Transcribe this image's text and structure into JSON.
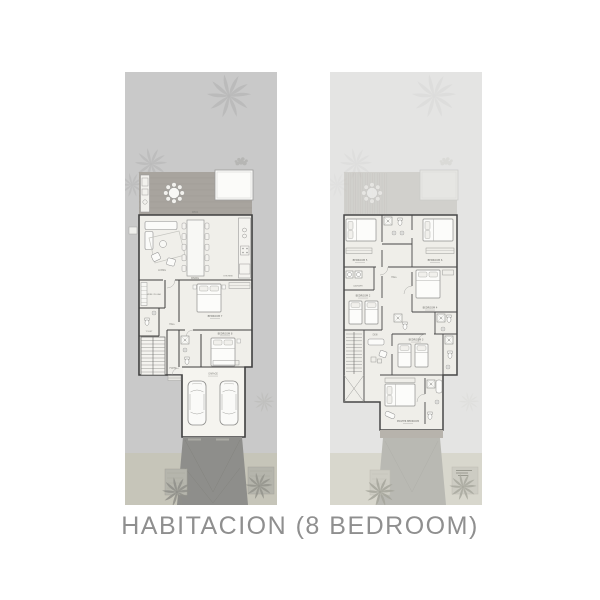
{
  "caption": "HABITACION (8 BEDROOM)",
  "plans": {
    "ground": {
      "labels": {
        "deck": "DECK",
        "living": "LIVING",
        "dining": "DINING",
        "kitchen": "KITCHEN",
        "wine_cellar": "WINE CELLAR",
        "toilet": "TOILET",
        "hall": "HALL",
        "bedroom7": "BEDROOM 7",
        "bedroom8": "BEDROOM 8",
        "foyer": "FOYER",
        "garage": "GARAGE"
      }
    },
    "first": {
      "labels": {
        "bedroom5": "BEDROOM 5",
        "bedroom6": "BEDROOM 6",
        "bedroom4": "BEDROOM 4",
        "bedroom2": "BEDROOM 2",
        "bedroom3": "BEDROOM 3",
        "master": "MASTER BEDROOM",
        "hall": "HALL",
        "laundry": "LAUNDRY",
        "den": "DEN"
      }
    }
  },
  "colors": {
    "caption_text": "#8f8f8f",
    "lot_ground": "#c9c9c9",
    "lot_first": "#e4e4e3",
    "deck": "#a8a49e",
    "floor": "#f0efea",
    "walls": "#3f3f3f",
    "driveway": "#8e8e8b",
    "sidewalk": "#c6c5b9"
  }
}
